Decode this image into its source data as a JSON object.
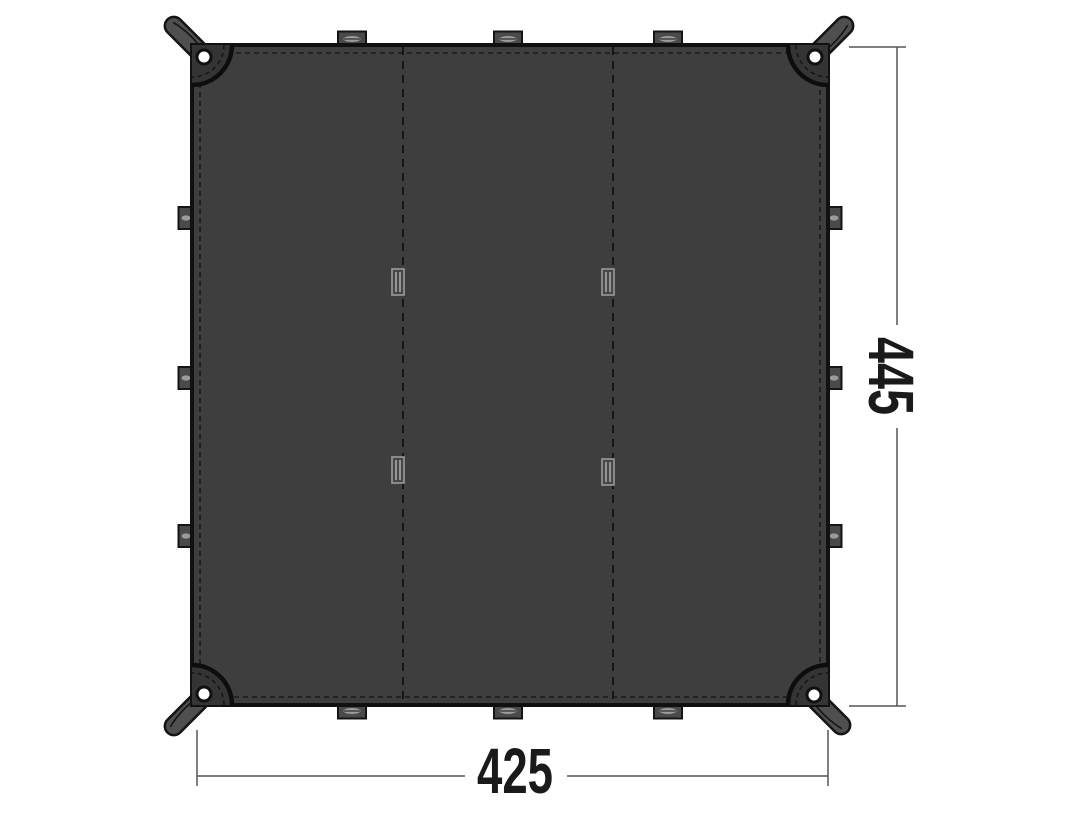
{
  "diagram": {
    "name": "tarp-dimension-diagram",
    "view": "top",
    "width_label": "425",
    "height_label": "445",
    "colors": {
      "background": "#ffffff",
      "fabric": "#3e3e3e",
      "corner_patch": "#343434",
      "edge": "#111111",
      "stitch": "#1a1a1a",
      "strap": "#4f4f4f",
      "loop": "#4a4a4a",
      "loop_slot": "#9b9b9b",
      "grommet": "#ffffff",
      "dimension_line": "#555555",
      "dimension_text": "#1a1a1a"
    },
    "features": {
      "corner_grommets": 4,
      "corner_straps": 4,
      "edge_loops_top": 3,
      "edge_loops_bottom": 3,
      "edge_loops_left": 3,
      "edge_loops_right": 3,
      "panel_seams": 2,
      "seam_loops": 4
    }
  }
}
